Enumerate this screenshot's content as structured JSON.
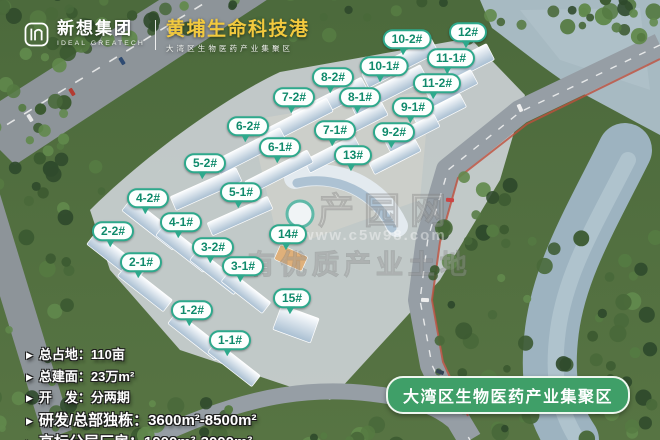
{
  "header": {
    "company_cn": "新想集团",
    "company_en": "IDEAL GREATECH",
    "project_title": "黄埔生命科技港",
    "project_subtitle": "大湾区生物医药产业集聚区"
  },
  "building_labels": [
    {
      "label": "10-2#",
      "x": 407,
      "y": 40
    },
    {
      "label": "12#",
      "x": 468,
      "y": 33
    },
    {
      "label": "11-1#",
      "x": 451,
      "y": 59
    },
    {
      "label": "10-1#",
      "x": 384,
      "y": 67
    },
    {
      "label": "8-2#",
      "x": 333,
      "y": 78
    },
    {
      "label": "11-2#",
      "x": 437,
      "y": 84
    },
    {
      "label": "7-2#",
      "x": 294,
      "y": 98
    },
    {
      "label": "8-1#",
      "x": 360,
      "y": 98
    },
    {
      "label": "9-1#",
      "x": 413,
      "y": 108
    },
    {
      "label": "6-2#",
      "x": 248,
      "y": 127
    },
    {
      "label": "7-1#",
      "x": 335,
      "y": 131
    },
    {
      "label": "9-2#",
      "x": 394,
      "y": 133
    },
    {
      "label": "6-1#",
      "x": 280,
      "y": 148
    },
    {
      "label": "13#",
      "x": 353,
      "y": 156
    },
    {
      "label": "5-2#",
      "x": 205,
      "y": 164
    },
    {
      "label": "5-1#",
      "x": 241,
      "y": 193
    },
    {
      "label": "4-2#",
      "x": 148,
      "y": 199
    },
    {
      "label": "4-1#",
      "x": 181,
      "y": 223
    },
    {
      "label": "2-2#",
      "x": 113,
      "y": 232
    },
    {
      "label": "14#",
      "x": 288,
      "y": 235
    },
    {
      "label": "3-2#",
      "x": 213,
      "y": 248
    },
    {
      "label": "2-1#",
      "x": 141,
      "y": 263
    },
    {
      "label": "3-1#",
      "x": 243,
      "y": 267
    },
    {
      "label": "15#",
      "x": 292,
      "y": 299
    },
    {
      "label": "1-2#",
      "x": 192,
      "y": 311
    },
    {
      "label": "1-1#",
      "x": 230,
      "y": 341
    }
  ],
  "stats": {
    "items": [
      {
        "label": "总占地：",
        "value": "110亩",
        "size": "sm"
      },
      {
        "label": "总建面：",
        "value": "23万m²",
        "size": "sm"
      },
      {
        "label": "开　发：",
        "value": "分两期",
        "size": "sm"
      },
      {
        "label": "研发/总部独栋：",
        "value": "3600m²-8500m²",
        "size": "lg"
      },
      {
        "label": "高标分层厂房：",
        "value": "1000m²-3000m²",
        "size": "lg"
      }
    ],
    "bullet": "▶"
  },
  "banner": {
    "label": "大湾区生物医药产业集聚区"
  },
  "watermark": {
    "title": "产园网",
    "url": "www.c5w98.com",
    "subtitle": "有优质产业土地"
  },
  "colors": {
    "bubble_border": "#2ea98c",
    "bubble_text": "#0f8a6b",
    "banner_green": "#3f9f68",
    "title_gold": "#f2c93e"
  }
}
